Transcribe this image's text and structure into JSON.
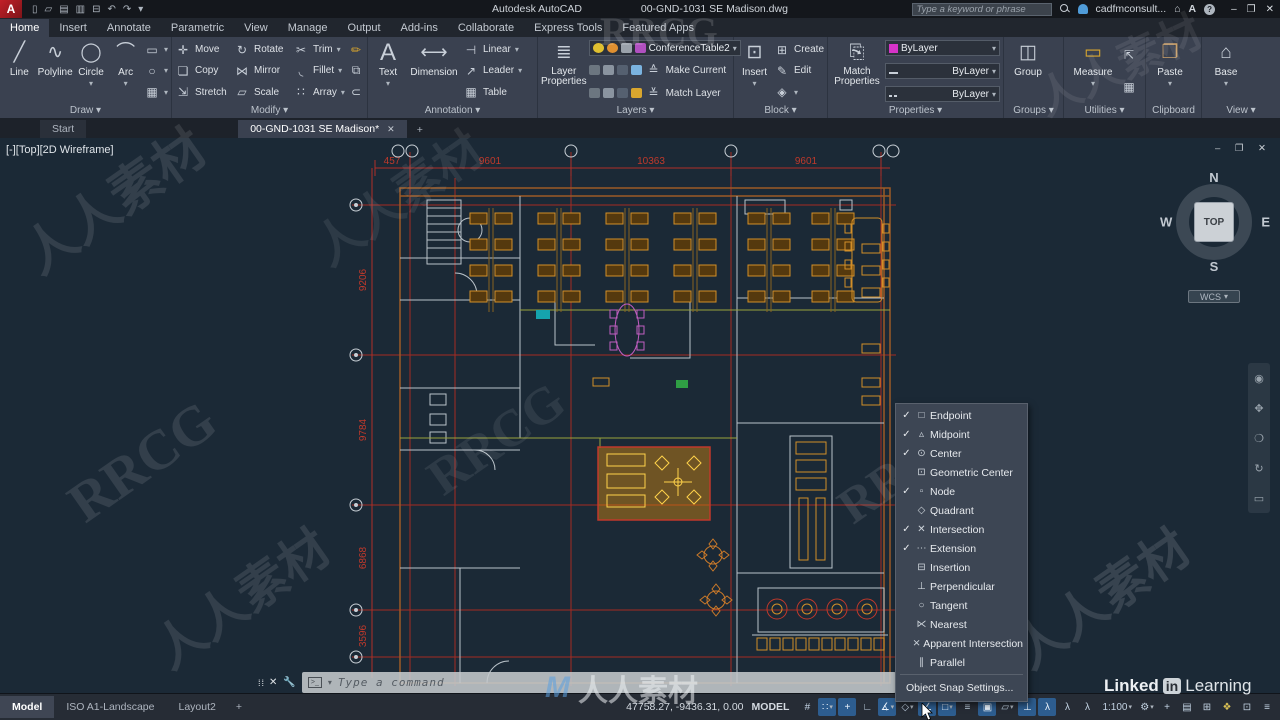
{
  "titlebar": {
    "app": "Autodesk AutoCAD",
    "doc": "00-GND-1031 SE Madison.dwg",
    "search_placeholder": "Type a keyword or phrase",
    "account": "cadfmconsult...",
    "qat": [
      "▯",
      "▱",
      "▤",
      "▥",
      "⊟",
      "↶",
      "↷",
      "▾"
    ],
    "min": "–",
    "restore": "❐",
    "close": "✕"
  },
  "ribbon": {
    "tabs": [
      "Home",
      "Insert",
      "Annotate",
      "Parametric",
      "View",
      "Manage",
      "Output",
      "Add-ins",
      "Collaborate",
      "Express Tools",
      "Featured Apps"
    ],
    "draw": {
      "title": "Draw ▾",
      "big": [
        [
          "╱",
          "Line"
        ],
        [
          "∿",
          "Polyline"
        ],
        [
          "◯",
          "Circle"
        ],
        [
          "⌒",
          "Arc"
        ]
      ],
      "small": [
        "▭",
        "○",
        "▦"
      ]
    },
    "modify": {
      "title": "Modify ▾",
      "items": [
        [
          "✛",
          "Move"
        ],
        [
          "↻",
          "Rotate"
        ],
        [
          "✂",
          "Trim"
        ],
        [
          "❏",
          "Copy"
        ],
        [
          "⋈",
          "Mirror"
        ],
        [
          "◟",
          "Fillet"
        ],
        [
          "⇲",
          "Stretch"
        ],
        [
          "▱",
          "Scale"
        ],
        [
          "∷",
          "Array"
        ]
      ]
    },
    "annotation": {
      "title": "Annotation ▾",
      "big": [
        [
          "A",
          "Text"
        ],
        [
          "⟷",
          "Dimension"
        ]
      ],
      "small": [
        [
          "⊣",
          "Linear"
        ],
        [
          "↗",
          "Leader"
        ],
        [
          "▦",
          "Table"
        ]
      ]
    },
    "layers": {
      "title": "Layers ▾",
      "big_label": "Layer Properties",
      "big_glyph": "≣",
      "combo_value": "ConferenceTable2",
      "make_current": "Make Current",
      "match_layer": "Match Layer"
    },
    "block": {
      "title": "Block ▾",
      "big": [
        "⊡",
        "Insert"
      ],
      "small": [
        [
          "⊞",
          "Create"
        ],
        [
          "✎",
          "Edit"
        ],
        [
          "◈",
          ""
        ]
      ]
    },
    "properties": {
      "title": "Properties ▾",
      "big_label": "Match Properties",
      "big_glyph": "⎘",
      "rows": [
        "ByLayer",
        "ByLayer",
        "ByLayer"
      ],
      "swatch": "#d633c8"
    },
    "groups": {
      "title": "Groups ▾",
      "big": [
        "◫",
        "Group"
      ]
    },
    "utilities": {
      "title": "Utilities ▾",
      "big": [
        "▭",
        "Measure"
      ]
    },
    "clipboard": {
      "title": "Clipboard",
      "big": [
        "❐",
        "Paste"
      ]
    },
    "view": {
      "title": "View ▾",
      "big": [
        "⌂",
        "Base"
      ]
    }
  },
  "file_tabs": {
    "start": "Start",
    "doc": "00-GND-1031 SE Madison*",
    "close": "✕",
    "add": "+"
  },
  "canvas": {
    "viewport_label": "[-][Top][2D Wireframe]",
    "win_buttons": "–  ❐  ✕",
    "viewcube": {
      "n": "N",
      "s": "S",
      "e": "E",
      "w": "W",
      "top": "TOP",
      "wcs": "WCS",
      "wcs_caret": "▾"
    }
  },
  "drawing": {
    "dims_top": [
      "457",
      "9601",
      "10363",
      "9601"
    ],
    "dims_left": [
      "9206",
      "9784",
      "6868",
      "3596"
    ]
  },
  "osnap": {
    "items": [
      {
        "check": "✓",
        "glyph": "□",
        "label": "Endpoint"
      },
      {
        "check": "✓",
        "glyph": "▵",
        "label": "Midpoint"
      },
      {
        "check": "✓",
        "glyph": "⊙",
        "label": "Center"
      },
      {
        "check": "",
        "glyph": "⊡",
        "label": "Geometric Center"
      },
      {
        "check": "✓",
        "glyph": "▫",
        "label": "Node"
      },
      {
        "check": "",
        "glyph": "◇",
        "label": "Quadrant"
      },
      {
        "check": "✓",
        "glyph": "✕",
        "label": "Intersection"
      },
      {
        "check": "✓",
        "glyph": "⋯",
        "label": "Extension"
      },
      {
        "check": "",
        "glyph": "⊟",
        "label": "Insertion"
      },
      {
        "check": "",
        "glyph": "⊥",
        "label": "Perpendicular"
      },
      {
        "check": "",
        "glyph": "○",
        "label": "Tangent"
      },
      {
        "check": "",
        "glyph": "⋉",
        "label": "Nearest"
      },
      {
        "check": "",
        "glyph": "⨯",
        "label": "Apparent Intersection"
      },
      {
        "check": "",
        "glyph": "∥",
        "label": "Parallel"
      }
    ],
    "settings": "Object Snap Settings..."
  },
  "command": {
    "prompt_icon": ">_",
    "placeholder": "Type a command"
  },
  "statusbar": {
    "layout_tabs": [
      "Model",
      "ISO A1-Landscape",
      "Layout2"
    ],
    "add_tab": "+",
    "coords": "47758.27, -9436.31, 0.00",
    "model": "MODEL",
    "icons": [
      {
        "g": "#",
        "c": ""
      },
      {
        "g": "∷",
        "c": "▾"
      },
      {
        "g": "+",
        "c": ""
      },
      {
        "g": "∟",
        "c": ""
      },
      {
        "g": "∡",
        "c": "▾"
      },
      {
        "g": "◇",
        "c": "▾"
      },
      {
        "g": "∠",
        "c": ""
      },
      {
        "g": "□",
        "c": "▾"
      },
      {
        "g": "≡",
        "c": ""
      },
      {
        "g": "▣",
        "c": ""
      },
      {
        "g": "▱",
        "c": "▾"
      },
      {
        "g": "⊥",
        "c": ""
      },
      {
        "g": "λ",
        "c": ""
      },
      {
        "g": "λ",
        "c": ""
      },
      {
        "g": "λ",
        "c": ""
      }
    ],
    "scale": "1:100",
    "scale_caret": "▾",
    "right_icons": [
      {
        "g": "⚙",
        "c": "▾"
      },
      {
        "g": "+",
        "c": ""
      },
      {
        "g": "▤",
        "c": ""
      },
      {
        "g": "⊞",
        "c": ""
      },
      {
        "g": "❖",
        "c": ""
      },
      {
        "g": "⊡",
        "c": ""
      },
      {
        "g": "≡",
        "c": ""
      }
    ]
  },
  "watermarks": {
    "cn": "人人素材",
    "en": "RRCG",
    "logo_m": "M",
    "logo_text": "人人素材"
  },
  "branding": {
    "li_1": "Linked",
    "li_in": "in",
    "li_2": "Learning"
  },
  "icon_names": [
    "search-icon",
    "user-icon",
    "cart-icon",
    "help-icon",
    "magnifier-icon",
    "gear-icon",
    "grid-icon",
    "snap-icon",
    "osnap-icon",
    "polar-icon"
  ]
}
